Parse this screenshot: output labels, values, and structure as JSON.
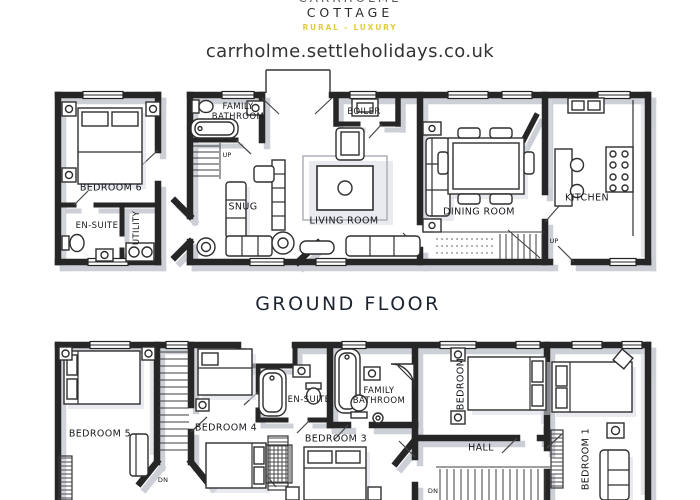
{
  "header": {
    "brand_top": "CARRHOLME",
    "brand_name": "COTTAGE",
    "tagline": "RURAL - LUXURY",
    "website": "carrholme.settleholidays.co.uk"
  },
  "ground_floor": {
    "title": "GROUND FLOOR",
    "rooms": {
      "bedroom6": "BEDROOM 6",
      "ensuite": "EN-SUITE",
      "utility": "UTILITY",
      "family_bathroom": "FAMILY BATHROOM",
      "snug": "SNUG",
      "boiler": "BOILER",
      "living_room": "LIVING ROOM",
      "dining_room": "DINING ROOM",
      "kitchen": "KITCHEN"
    },
    "stairs": {
      "up_snug": "UP",
      "up_dining": "UP"
    }
  },
  "first_floor": {
    "rooms": {
      "bedroom5": "BEDROOM 5",
      "bedroom4": "BEDROOM 4",
      "ensuite": "EN-SUITE",
      "family_bathroom": "FAMILY BATHROOM",
      "bedroom3": "BEDROOM 3",
      "bedroom2": "BEDROOM",
      "hall": "HALL",
      "bedroom1": "BEDROOM 1"
    },
    "stairs": {
      "dn_stairwell": "DN",
      "dn_hall": "DN"
    }
  },
  "colors": {
    "tagline": "#e2cd3e",
    "ink": "#262626",
    "wall_shadow": "#c5c7d1"
  }
}
